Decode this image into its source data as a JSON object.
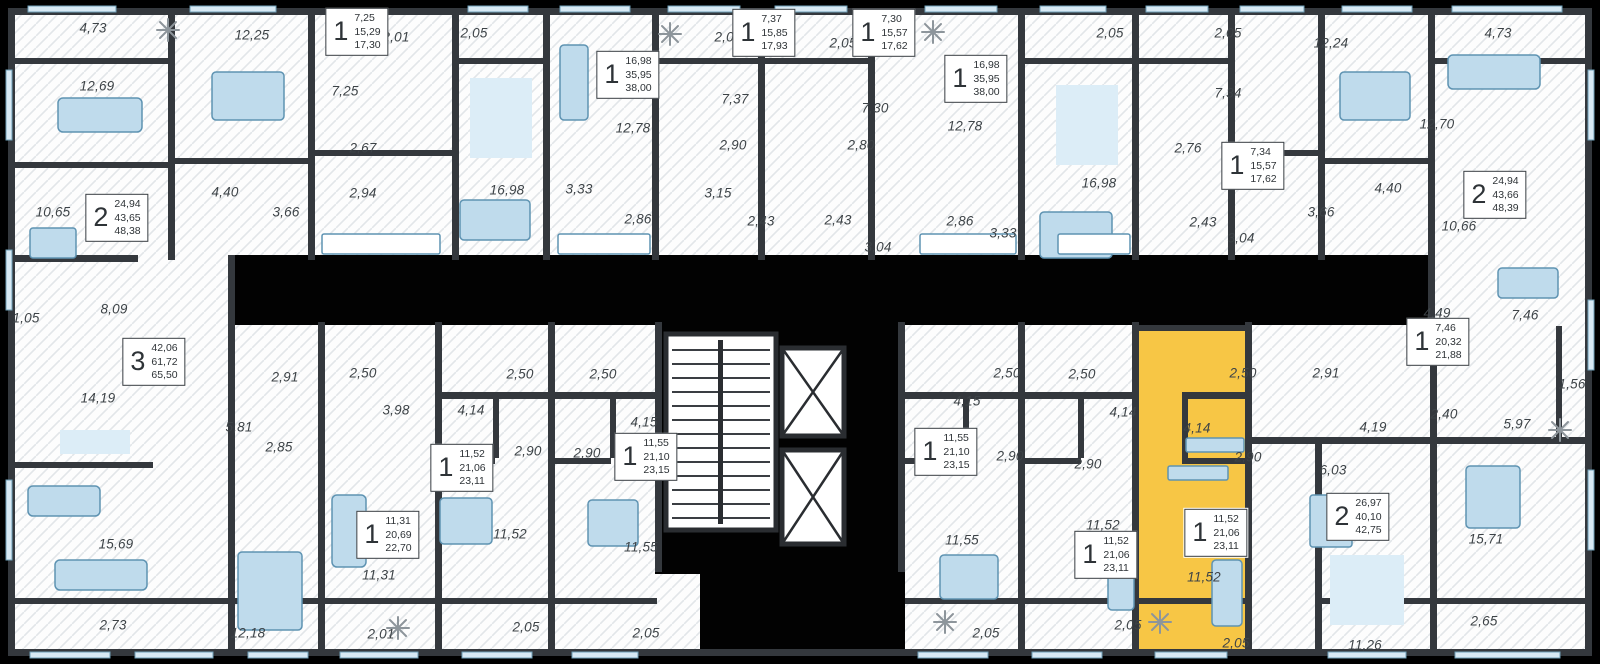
{
  "plan": {
    "type": "residential-floor-plan",
    "highlight_color": "#F7C645",
    "wall_color": "#34383d",
    "furniture_color": "#BFDBEC",
    "selected_unit": {
      "rooms": "1",
      "area_living": "11,52",
      "area_apartment": "21,06",
      "area_total": "23,11"
    },
    "room_labels": [
      {
        "text": "4,73",
        "x": 93,
        "y": 28
      },
      {
        "text": "12,25",
        "x": 252,
        "y": 35
      },
      {
        "text": "2,01",
        "x": 396,
        "y": 37
      },
      {
        "text": "2,05",
        "x": 474,
        "y": 33
      },
      {
        "text": "12,69",
        "x": 97,
        "y": 86
      },
      {
        "text": "7,25",
        "x": 345,
        "y": 91
      },
      {
        "text": "2,67",
        "x": 363,
        "y": 148
      },
      {
        "text": "2,94",
        "x": 363,
        "y": 193
      },
      {
        "text": "4,40",
        "x": 225,
        "y": 192
      },
      {
        "text": "3,66",
        "x": 286,
        "y": 212
      },
      {
        "text": "10,65",
        "x": 53,
        "y": 212
      },
      {
        "text": "2,08",
        "x": 728,
        "y": 37
      },
      {
        "text": "12,78",
        "x": 633,
        "y": 128
      },
      {
        "text": "7,37",
        "x": 735,
        "y": 99
      },
      {
        "text": "2,90",
        "x": 733,
        "y": 145
      },
      {
        "text": "16,98",
        "x": 507,
        "y": 190
      },
      {
        "text": "3,33",
        "x": 579,
        "y": 189
      },
      {
        "text": "2,86",
        "x": 638,
        "y": 219
      },
      {
        "text": "2,43",
        "x": 761,
        "y": 221
      },
      {
        "text": "2,43",
        "x": 838,
        "y": 220
      },
      {
        "text": "3,15",
        "x": 718,
        "y": 193
      },
      {
        "text": "3,04",
        "x": 878,
        "y": 247
      },
      {
        "text": "2,05",
        "x": 843,
        "y": 43
      },
      {
        "text": "7,30",
        "x": 875,
        "y": 108
      },
      {
        "text": "2,80",
        "x": 861,
        "y": 145
      },
      {
        "text": "12,78",
        "x": 965,
        "y": 126
      },
      {
        "text": "2,86",
        "x": 960,
        "y": 221
      },
      {
        "text": "3,33",
        "x": 1003,
        "y": 233
      },
      {
        "text": "16,98",
        "x": 1099,
        "y": 183
      },
      {
        "text": "2,05",
        "x": 1110,
        "y": 33
      },
      {
        "text": "2,76",
        "x": 1188,
        "y": 148
      },
      {
        "text": "2,43",
        "x": 1203,
        "y": 222
      },
      {
        "text": "3,04",
        "x": 1241,
        "y": 238
      },
      {
        "text": "2,05",
        "x": 1228,
        "y": 33
      },
      {
        "text": "7,34",
        "x": 1228,
        "y": 93
      },
      {
        "text": "12,24",
        "x": 1331,
        "y": 43
      },
      {
        "text": "3,66",
        "x": 1321,
        "y": 212
      },
      {
        "text": "4,40",
        "x": 1388,
        "y": 188
      },
      {
        "text": "10,66",
        "x": 1459,
        "y": 226
      },
      {
        "text": "4,73",
        "x": 1498,
        "y": 33
      },
      {
        "text": "12,70",
        "x": 1437,
        "y": 124
      },
      {
        "text": "8,09",
        "x": 114,
        "y": 309
      },
      {
        "text": "1,05",
        "x": 26,
        "y": 318
      },
      {
        "text": "14,19",
        "x": 98,
        "y": 398
      },
      {
        "text": "15,69",
        "x": 116,
        "y": 544
      },
      {
        "text": "2,73",
        "x": 113,
        "y": 625
      },
      {
        "text": "5,81",
        "x": 239,
        "y": 427
      },
      {
        "text": "2,85",
        "x": 279,
        "y": 447
      },
      {
        "text": "2,91",
        "x": 285,
        "y": 377
      },
      {
        "text": "2,50",
        "x": 363,
        "y": 373
      },
      {
        "text": "3,98",
        "x": 396,
        "y": 410
      },
      {
        "text": "12,18",
        "x": 248,
        "y": 633
      },
      {
        "text": "11,31",
        "x": 379,
        "y": 575
      },
      {
        "text": "2,01",
        "x": 381,
        "y": 634
      },
      {
        "text": "4,14",
        "x": 471,
        "y": 410
      },
      {
        "text": "2,50",
        "x": 520,
        "y": 374
      },
      {
        "text": "2,50",
        "x": 603,
        "y": 374
      },
      {
        "text": "4,15",
        "x": 644,
        "y": 422
      },
      {
        "text": "2,90",
        "x": 528,
        "y": 451
      },
      {
        "text": "2,90",
        "x": 587,
        "y": 453
      },
      {
        "text": "11,52",
        "x": 510,
        "y": 534
      },
      {
        "text": "11,55",
        "x": 641,
        "y": 547
      },
      {
        "text": "2,05",
        "x": 526,
        "y": 627
      },
      {
        "text": "2,05",
        "x": 646,
        "y": 633
      },
      {
        "text": "4,15",
        "x": 967,
        "y": 401
      },
      {
        "text": "2,50",
        "x": 1007,
        "y": 373
      },
      {
        "text": "2,50",
        "x": 1082,
        "y": 374
      },
      {
        "text": "4,14",
        "x": 1123,
        "y": 412
      },
      {
        "text": "2,90",
        "x": 1010,
        "y": 456
      },
      {
        "text": "2,90",
        "x": 1088,
        "y": 464
      },
      {
        "text": "11,55",
        "x": 962,
        "y": 540
      },
      {
        "text": "11,52",
        "x": 1103,
        "y": 525
      },
      {
        "text": "2,05",
        "x": 986,
        "y": 633
      },
      {
        "text": "2,05",
        "x": 1128,
        "y": 625
      },
      {
        "text": "2,50",
        "x": 1243,
        "y": 373,
        "in_highlight": true
      },
      {
        "text": "4,14",
        "x": 1197,
        "y": 428,
        "in_highlight": true
      },
      {
        "text": "2,90",
        "x": 1248,
        "y": 457,
        "in_highlight": true
      },
      {
        "text": "11,52",
        "x": 1204,
        "y": 577,
        "in_highlight": true
      },
      {
        "text": "2,05",
        "x": 1236,
        "y": 643,
        "in_highlight": true
      },
      {
        "text": "2,91",
        "x": 1326,
        "y": 373
      },
      {
        "text": "4,19",
        "x": 1373,
        "y": 427
      },
      {
        "text": "6,03",
        "x": 1333,
        "y": 470
      },
      {
        "text": "11,26",
        "x": 1365,
        "y": 645
      },
      {
        "text": "15,71",
        "x": 1486,
        "y": 539
      },
      {
        "text": "2,65",
        "x": 1484,
        "y": 621
      },
      {
        "text": "2,40",
        "x": 1444,
        "y": 414
      },
      {
        "text": "5,97",
        "x": 1517,
        "y": 424
      },
      {
        "text": "1,56",
        "x": 1572,
        "y": 384
      },
      {
        "text": "4,49",
        "x": 1437,
        "y": 313
      },
      {
        "text": "7,46",
        "x": 1525,
        "y": 315
      }
    ],
    "unit_boxes": [
      {
        "rooms": "1",
        "areas": [
          "7,25",
          "15,29",
          "17,30"
        ],
        "x": 357,
        "y": 32
      },
      {
        "rooms": "1",
        "areas": [
          "16,98",
          "35,95",
          "38,00"
        ],
        "x": 628,
        "y": 75
      },
      {
        "rooms": "1",
        "areas": [
          "7,37",
          "15,85",
          "17,93"
        ],
        "x": 764,
        "y": 33
      },
      {
        "rooms": "1",
        "areas": [
          "7,30",
          "15,57",
          "17,62"
        ],
        "x": 884,
        "y": 33
      },
      {
        "rooms": "1",
        "areas": [
          "16,98",
          "35,95",
          "38,00"
        ],
        "x": 976,
        "y": 79
      },
      {
        "rooms": "1",
        "areas": [
          "7,34",
          "15,57",
          "17,62"
        ],
        "x": 1253,
        "y": 166
      },
      {
        "rooms": "2",
        "areas": [
          "24,94",
          "43,66",
          "48,39"
        ],
        "x": 1495,
        "y": 195
      },
      {
        "rooms": "2",
        "areas": [
          "24,94",
          "43,65",
          "48,38"
        ],
        "x": 117,
        "y": 218
      },
      {
        "rooms": "3",
        "areas": [
          "42,06",
          "61,72",
          "65,50"
        ],
        "x": 154,
        "y": 362
      },
      {
        "rooms": "1",
        "areas": [
          "7,46",
          "20,32",
          "21,88"
        ],
        "x": 1438,
        "y": 342
      },
      {
        "rooms": "1",
        "areas": [
          "11,31",
          "20,69",
          "22,70"
        ],
        "x": 388,
        "y": 535
      },
      {
        "rooms": "1",
        "areas": [
          "11,52",
          "21,06",
          "23,11"
        ],
        "x": 462,
        "y": 468
      },
      {
        "rooms": "1",
        "areas": [
          "11,55",
          "21,10",
          "23,15"
        ],
        "x": 646,
        "y": 457
      },
      {
        "rooms": "1",
        "areas": [
          "11,55",
          "21,10",
          "23,15"
        ],
        "x": 946,
        "y": 452
      },
      {
        "rooms": "1",
        "areas": [
          "11,52",
          "21,06",
          "23,11"
        ],
        "x": 1106,
        "y": 555
      },
      {
        "rooms": "1",
        "areas": [
          "11,52",
          "21,06",
          "23,11"
        ],
        "x": 1216,
        "y": 533,
        "highlighted": true
      },
      {
        "rooms": "2",
        "areas": [
          "26,97",
          "40,10",
          "42,75"
        ],
        "x": 1358,
        "y": 517
      }
    ]
  }
}
